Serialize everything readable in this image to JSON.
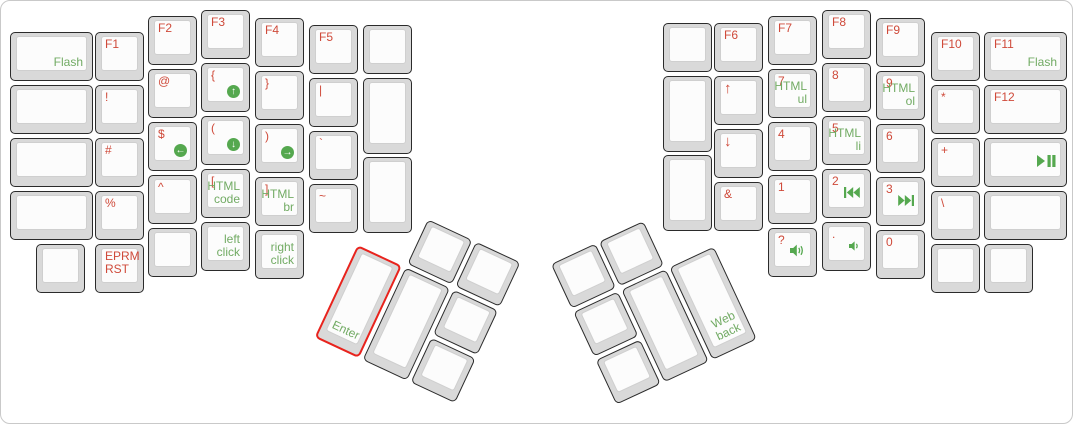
{
  "window": {
    "title": "ErgoDox keyboard layout",
    "frame_border": "#c9c9c9",
    "background": "#ffffff"
  },
  "colors": {
    "red_legend": "#cf4a3a",
    "green_legend": "#72ab64",
    "icon_green": "#55a84f",
    "highlight_border": "#e8231d",
    "cap_outer": "#d9d9d9",
    "cap_border": "#2b2b2b",
    "cap_surface": "#fcfcfc"
  },
  "keyboard": {
    "unit_px": 53,
    "clusters": {
      "left": {
        "x": 379,
        "y": 196,
        "deg": 25
      },
      "right": {
        "x": 694,
        "y": 196,
        "deg": -25
      }
    },
    "keys": [
      {
        "name": "key-flash",
        "x": 9,
        "y": 31,
        "w": 83,
        "green": "Flash"
      },
      {
        "name": "key-blank-l1",
        "x": 9,
        "y": 84,
        "w": 83
      },
      {
        "name": "key-blank-l2",
        "x": 9,
        "y": 137,
        "w": 83
      },
      {
        "name": "key-blank-l3",
        "x": 9,
        "y": 190,
        "w": 83
      },
      {
        "name": "key-blank-l4",
        "x": 35,
        "y": 243
      },
      {
        "name": "key-f1",
        "x": 94,
        "y": 31,
        "red": "F1"
      },
      {
        "name": "key-exclamation",
        "x": 94,
        "y": 84,
        "red": "!"
      },
      {
        "name": "key-hash",
        "x": 94,
        "y": 137,
        "red": "#"
      },
      {
        "name": "key-percent",
        "x": 94,
        "y": 190,
        "red": "%"
      },
      {
        "name": "key-eprm-rst",
        "x": 94,
        "y": 243,
        "red": "EPRM\nRST"
      },
      {
        "name": "key-f2",
        "x": 147,
        "y": 15,
        "red": "F2"
      },
      {
        "name": "key-at",
        "x": 147,
        "y": 68,
        "red": "@"
      },
      {
        "name": "key-dollar-scroll-left",
        "x": 147,
        "y": 121,
        "red": "$",
        "icon": "scroll-left"
      },
      {
        "name": "key-caret",
        "x": 147,
        "y": 174,
        "red": "^"
      },
      {
        "name": "key-blank-l5",
        "x": 147,
        "y": 227
      },
      {
        "name": "key-f3",
        "x": 200,
        "y": 9,
        "red": "F3"
      },
      {
        "name": "key-lbrace-scroll-up",
        "x": 200,
        "y": 62,
        "red": "{",
        "icon": "scroll-up"
      },
      {
        "name": "key-lparen-scroll-down",
        "x": 200,
        "y": 115,
        "red": "(",
        "icon": "scroll-down"
      },
      {
        "name": "key-lbracket-html-code",
        "x": 200,
        "y": 168,
        "red": "[",
        "green": "HTML\ncode"
      },
      {
        "name": "key-left-click",
        "x": 200,
        "y": 221,
        "green": "left\nclick"
      },
      {
        "name": "key-f4",
        "x": 254,
        "y": 17,
        "red": "F4"
      },
      {
        "name": "key-rbrace",
        "x": 254,
        "y": 70,
        "red": "}"
      },
      {
        "name": "key-rparen-scroll-right",
        "x": 254,
        "y": 123,
        "red": ")",
        "icon": "scroll-right"
      },
      {
        "name": "key-rbracket-html-br",
        "x": 254,
        "y": 176,
        "red": "]",
        "green": "HTML\nbr"
      },
      {
        "name": "key-right-click",
        "x": 254,
        "y": 229,
        "green": "right\nclick"
      },
      {
        "name": "key-f5",
        "x": 308,
        "y": 24,
        "red": "F5"
      },
      {
        "name": "key-pipe",
        "x": 308,
        "y": 77,
        "red": "|"
      },
      {
        "name": "key-backtick",
        "x": 308,
        "y": 130,
        "red": "`"
      },
      {
        "name": "key-tilde",
        "x": 308,
        "y": 183,
        "red": "~"
      },
      {
        "name": "key-blank-l6",
        "x": 362,
        "y": 24
      },
      {
        "name": "key-blank-l7",
        "x": 362,
        "y": 77,
        "h": 76
      },
      {
        "name": "key-blank-l8",
        "x": 362,
        "y": 156,
        "h": 76
      },
      {
        "name": "key-blank-r1",
        "x": 662,
        "y": 22
      },
      {
        "name": "key-blank-r2",
        "x": 662,
        "y": 75,
        "h": 76
      },
      {
        "name": "key-blank-r3",
        "x": 662,
        "y": 154,
        "h": 76
      },
      {
        "name": "key-f6",
        "x": 713,
        "y": 22,
        "red": "F6"
      },
      {
        "name": "key-up-arrow",
        "x": 713,
        "y": 75,
        "red": "↑",
        "arrow": true
      },
      {
        "name": "key-down-arrow",
        "x": 713,
        "y": 128,
        "red": "↓",
        "arrow": true
      },
      {
        "name": "key-ampersand",
        "x": 713,
        "y": 181,
        "red": "&"
      },
      {
        "name": "key-f7",
        "x": 767,
        "y": 15,
        "red": "F7"
      },
      {
        "name": "key-7-html-ul",
        "x": 767,
        "y": 68,
        "red": "7",
        "green": "HTML\nul"
      },
      {
        "name": "key-4",
        "x": 767,
        "y": 121,
        "red": "4"
      },
      {
        "name": "key-1",
        "x": 767,
        "y": 174,
        "red": "1"
      },
      {
        "name": "key-question-volume-up",
        "x": 767,
        "y": 227,
        "red": "?",
        "icon": "volume-up"
      },
      {
        "name": "key-f8",
        "x": 821,
        "y": 9,
        "red": "F8"
      },
      {
        "name": "key-8",
        "x": 821,
        "y": 62,
        "red": "8"
      },
      {
        "name": "key-5-html-li",
        "x": 821,
        "y": 115,
        "red": "5",
        "green": "HTML\nli"
      },
      {
        "name": "key-2-prev-track",
        "x": 821,
        "y": 168,
        "red": "2",
        "icon": "prev-track"
      },
      {
        "name": "key-dot-volume-down",
        "x": 821,
        "y": 221,
        "red": ".",
        "icon": "volume-down"
      },
      {
        "name": "key-f9",
        "x": 875,
        "y": 17,
        "red": "F9"
      },
      {
        "name": "key-9-html-ol",
        "x": 875,
        "y": 70,
        "red": "9",
        "green": "HTML\nol"
      },
      {
        "name": "key-6",
        "x": 875,
        "y": 123,
        "red": "6"
      },
      {
        "name": "key-3-next-track",
        "x": 875,
        "y": 176,
        "red": "3",
        "icon": "next-track"
      },
      {
        "name": "key-0",
        "x": 875,
        "y": 229,
        "red": "0"
      },
      {
        "name": "key-f10",
        "x": 930,
        "y": 31,
        "red": "F10"
      },
      {
        "name": "key-asterisk",
        "x": 930,
        "y": 84,
        "red": "*"
      },
      {
        "name": "key-plus",
        "x": 930,
        "y": 137,
        "red": "+"
      },
      {
        "name": "key-backslash",
        "x": 930,
        "y": 190,
        "red": "\\"
      },
      {
        "name": "key-blank-r4",
        "x": 930,
        "y": 243
      },
      {
        "name": "key-f11-flash",
        "x": 983,
        "y": 31,
        "w": 83,
        "red": "F11",
        "green": "Flash"
      },
      {
        "name": "key-f12",
        "x": 983,
        "y": 84,
        "w": 83,
        "red": "F12"
      },
      {
        "name": "key-play-pause",
        "x": 983,
        "y": 137,
        "w": 83,
        "icon": "play-pause"
      },
      {
        "name": "key-blank-r5",
        "x": 983,
        "y": 190,
        "w": 83
      },
      {
        "name": "key-blank-r6",
        "x": 983,
        "y": 243
      },
      {
        "name": "key-thumb-l-blank1",
        "cluster": "left",
        "x": 53,
        "y": 0
      },
      {
        "name": "key-thumb-l-blank2",
        "cluster": "left",
        "x": 106,
        "y": 0
      },
      {
        "name": "key-enter",
        "cluster": "left",
        "x": 0,
        "y": 53,
        "h": 102,
        "green": "Enter",
        "green_pos": "bl",
        "highlight": true
      },
      {
        "name": "key-thumb-l-blank3",
        "cluster": "left",
        "x": 53,
        "y": 53,
        "h": 102
      },
      {
        "name": "key-thumb-l-blank4",
        "cluster": "left",
        "x": 106,
        "y": 53
      },
      {
        "name": "key-thumb-l-blank5",
        "cluster": "left",
        "x": 106,
        "y": 106
      },
      {
        "name": "key-thumb-r-blank1",
        "cluster": "right",
        "x": -106,
        "y": 0
      },
      {
        "name": "key-thumb-r-blank2",
        "cluster": "right",
        "x": -159,
        "y": 0
      },
      {
        "name": "key-web-back",
        "cluster": "right",
        "x": -53,
        "y": 53,
        "h": 102,
        "green": "Web\nback"
      },
      {
        "name": "key-thumb-r-blank3",
        "cluster": "right",
        "x": -106,
        "y": 53,
        "h": 102
      },
      {
        "name": "key-thumb-r-blank4",
        "cluster": "right",
        "x": -159,
        "y": 53
      },
      {
        "name": "key-thumb-r-blank5",
        "cluster": "right",
        "x": -159,
        "y": 106
      }
    ]
  }
}
